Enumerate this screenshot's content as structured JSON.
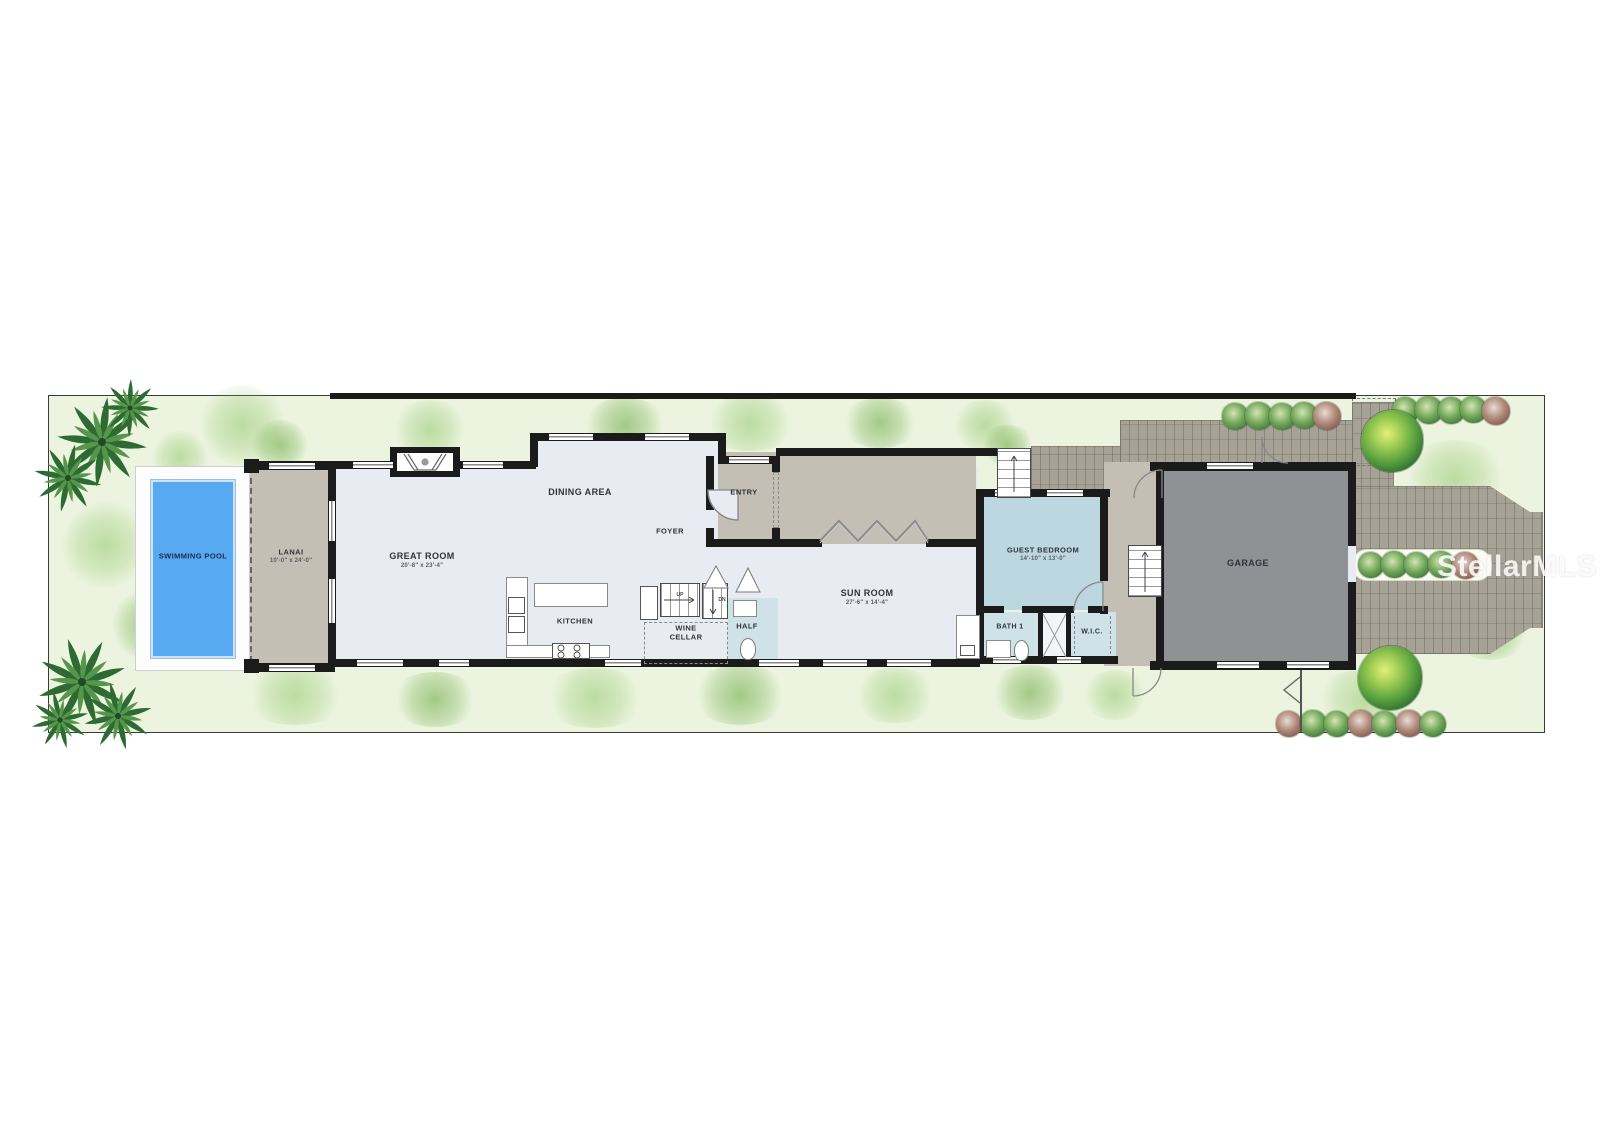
{
  "watermark": "StellarMLS",
  "rooms": {
    "swimming_pool": {
      "label": "SWIMMING POOL"
    },
    "lanai": {
      "label": "LANAI",
      "dims": "10'-0\" x 24'-0\""
    },
    "great_room": {
      "label": "GREAT ROOM",
      "dims": "20'-8\" x 23'-4\""
    },
    "dining_area": {
      "label": "DINING AREA"
    },
    "kitchen": {
      "label": "KITCHEN"
    },
    "foyer": {
      "label": "FOYER"
    },
    "entry": {
      "label": "ENTRY"
    },
    "wine_cellar": {
      "label": "WINE CELLAR"
    },
    "half_bath": {
      "label": "HALF"
    },
    "sun_room": {
      "label": "SUN ROOM",
      "dims": "27'-6\" x 14'-4\""
    },
    "guest_bedroom": {
      "label": "GUEST BEDROOM",
      "dims": "14'-10\" x 13'-0\""
    },
    "bath_1": {
      "label": "BATH 1"
    },
    "wic": {
      "label": "W.I.C."
    },
    "garage": {
      "label": "GARAGE"
    }
  },
  "stairs": {
    "up_label": "UP",
    "dn_label": "DN"
  },
  "colors": {
    "pool_blue": "#57a9f1",
    "lawn_green": "#ecf4df",
    "interior_floor": "#e9ebf2",
    "patio_tan": "#c4bfb5",
    "bedroom_blue": "#bdd7e0",
    "garage_gray": "#8f9194",
    "paver_gray": "#a6a296",
    "wall_black": "#1b1b1b"
  }
}
